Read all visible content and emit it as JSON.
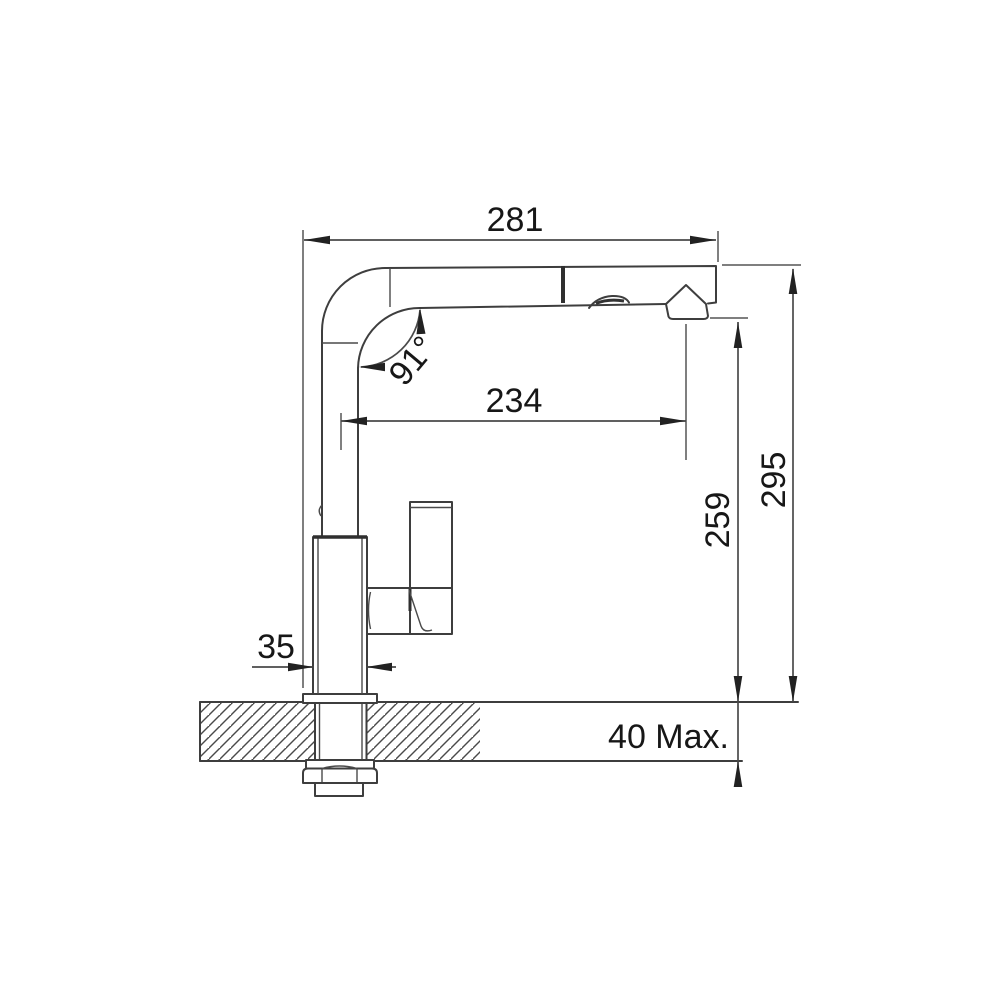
{
  "drawing": {
    "kind": "technical-dimension-drawing",
    "subject": "pull-out kitchen faucet side view with countertop mounting cross-section",
    "colors": {
      "line": "#3e3e3e",
      "dimension_line": "#4a4a4a",
      "text": "#171717",
      "arrow": "#222222",
      "background": "#ffffff"
    },
    "dims": {
      "overall_reach": "281",
      "reach_to_aerator": "234",
      "spout_angle": "91°",
      "height_to_aerator": "259",
      "overall_height": "295",
      "body_width": "35",
      "max_counter_thickness": "40 Max."
    }
  }
}
